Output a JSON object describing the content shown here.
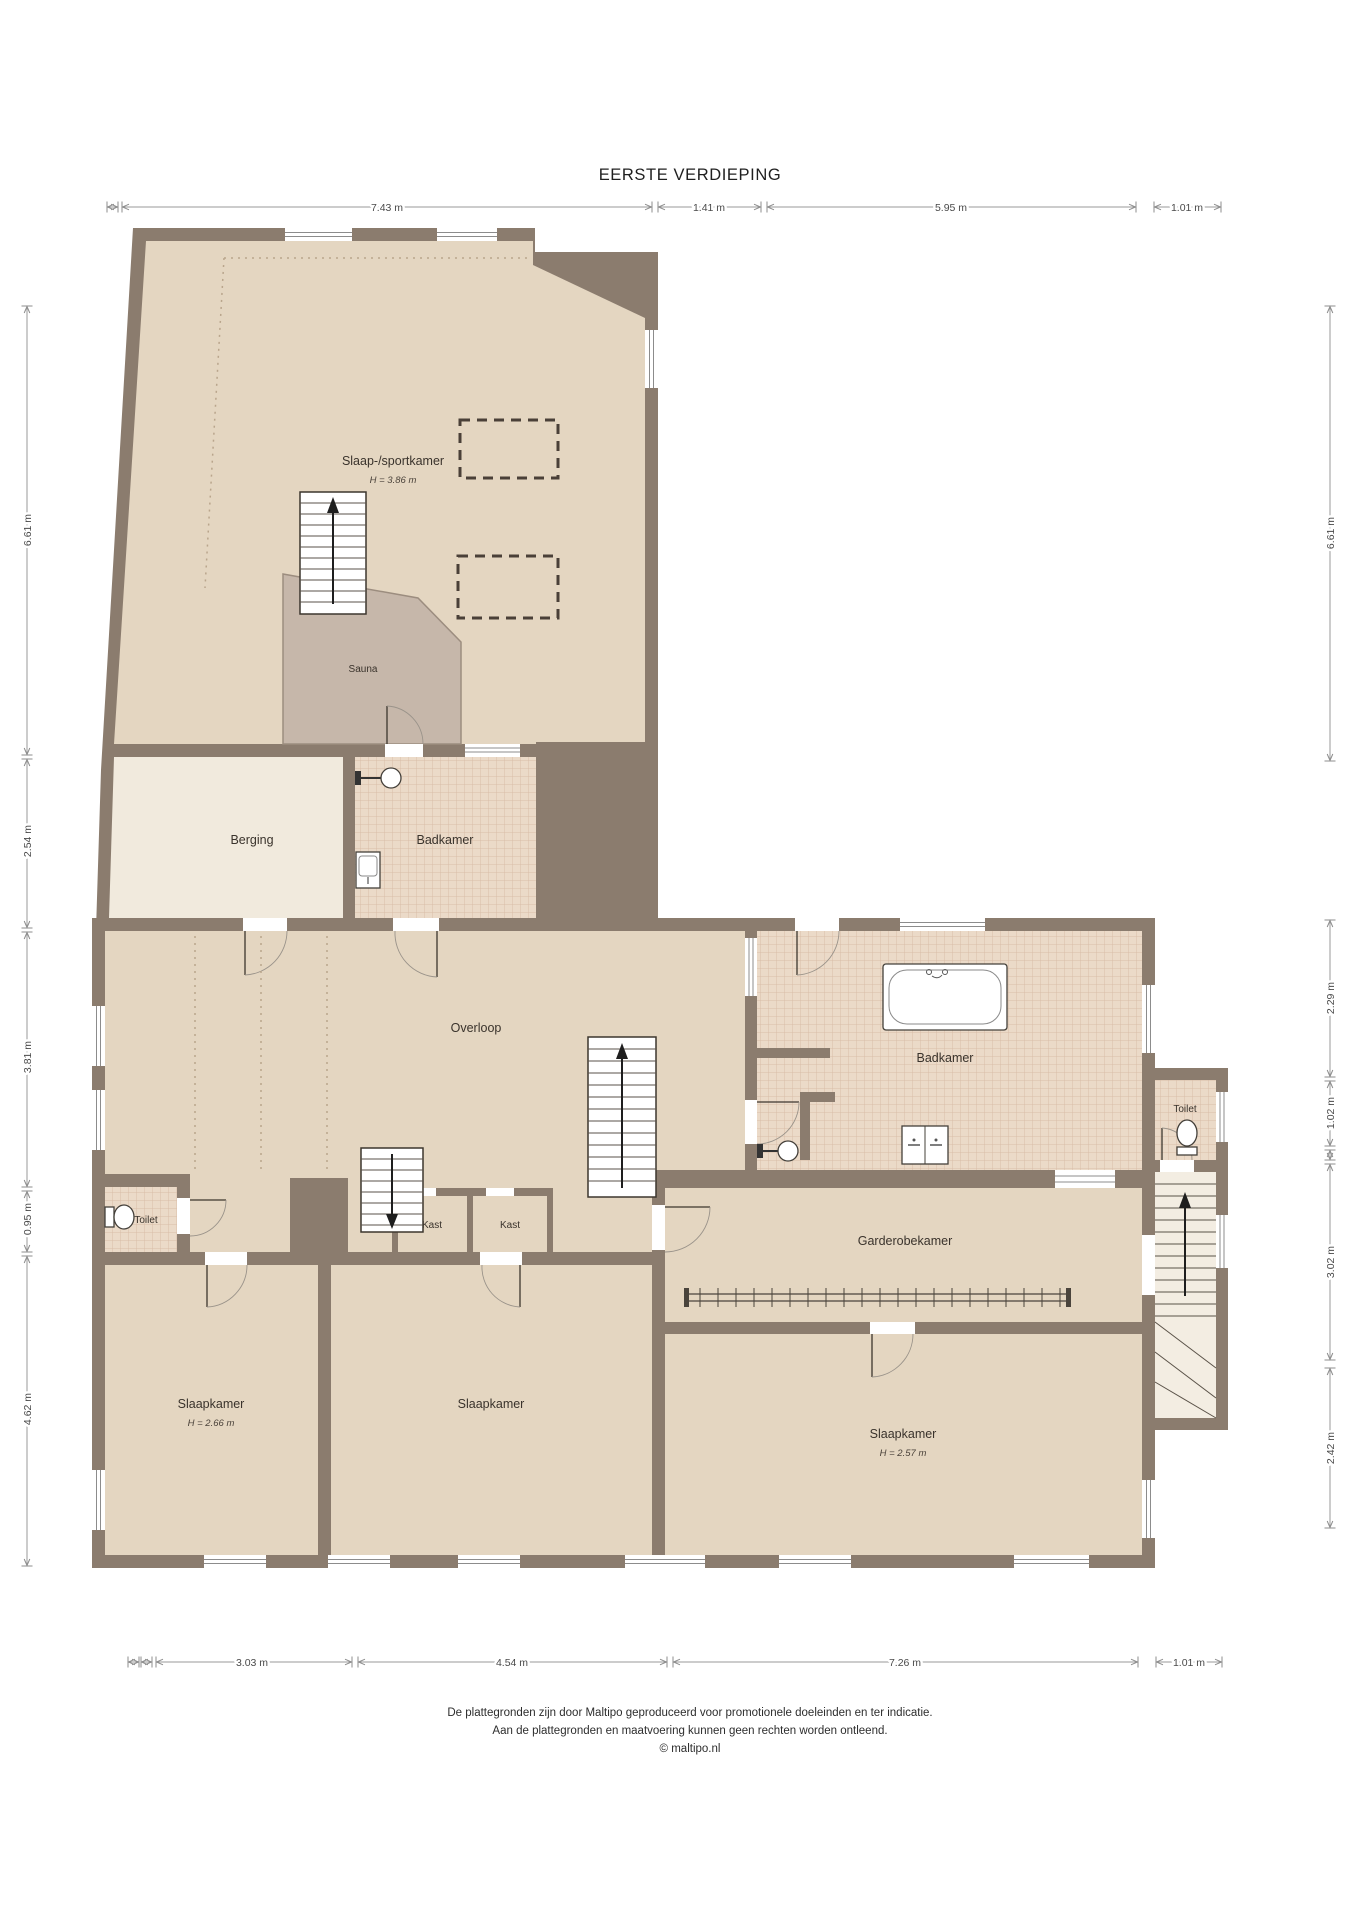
{
  "title": "EERSTE VERDIEPING",
  "rooms": {
    "slaap_sportkamer": {
      "label": "Slaap-/sportkamer",
      "height": "H = 3.86 m"
    },
    "sauna": {
      "label": "Sauna"
    },
    "berging": {
      "label": "Berging"
    },
    "badkamer_boven": {
      "label": "Badkamer"
    },
    "overloop": {
      "label": "Overloop"
    },
    "badkamer": {
      "label": "Badkamer"
    },
    "toilet_rechts": {
      "label": "Toilet"
    },
    "garderobekamer": {
      "label": "Garderobekamer"
    },
    "toilet_links": {
      "label": "Toilet"
    },
    "kast_links": {
      "label": "Kast"
    },
    "kast_rechts": {
      "label": "Kast"
    },
    "slaapkamer_links": {
      "label": "Slaapkamer",
      "height": "H = 2.66 m"
    },
    "slaapkamer_midden": {
      "label": "Slaapkamer"
    },
    "slaapkamer_rechts": {
      "label": "Slaapkamer",
      "height": "H = 2.57 m"
    }
  },
  "dimensions": {
    "top": [
      {
        "label": "7.43 m"
      },
      {
        "label": "1.41 m"
      },
      {
        "label": "5.95 m"
      },
      {
        "label": "1.01 m"
      }
    ],
    "bottom": [
      {
        "label": "3.03 m"
      },
      {
        "label": "4.54 m"
      },
      {
        "label": "7.26 m"
      },
      {
        "label": "1.01 m"
      }
    ],
    "left": [
      {
        "label": "6.61 m"
      },
      {
        "label": "2.54 m"
      },
      {
        "label": "3.81 m"
      },
      {
        "label": "0.95 m"
      },
      {
        "label": "4.62 m"
      }
    ],
    "right": [
      {
        "label": "6.61 m"
      },
      {
        "label": "2.29 m"
      },
      {
        "label": "1.02 m"
      },
      {
        "label": "3.02 m"
      },
      {
        "label": "2.42 m"
      }
    ]
  },
  "footer": {
    "line1": "De plattegronden zijn door Maltipo geproduceerd voor promotionele doeleinden en ter indicatie.",
    "line2": "Aan de plattegronden en maatvoering kunnen geen rechten worden ontleend.",
    "line3": "© maltipo.nl"
  },
  "colors": {
    "wall": "#8b7c6e",
    "room_beige": "#e4d6c1",
    "room_light": "#f1eadd",
    "sauna": "#c6b7aa",
    "tile_base": "#ebdac8",
    "tile_line": "#d8bda8"
  }
}
